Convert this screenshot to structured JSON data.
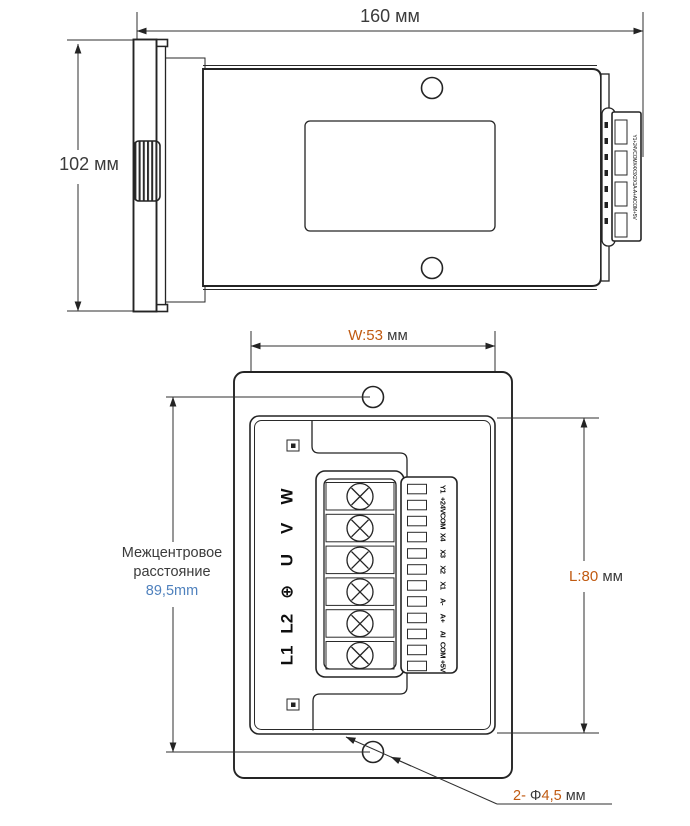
{
  "colors": {
    "line": "#242424",
    "dimension_text": "#3b3b3b",
    "accent_orange": "#c05a11",
    "accent_blue": "#4f81bd"
  },
  "top_view": {
    "width_label": "160 мм",
    "height_label": "102 мм",
    "connector_side_text": "Y1+24VCOMX4X3X2X1A-A+AICOM+5V"
  },
  "front_view": {
    "width_value": "W:53",
    "width_unit": " мм",
    "length_value": "L:80",
    "length_unit": " мм",
    "center_distance": {
      "line1": "Межцентровое",
      "line2": "расстояние",
      "value": "89,5mm"
    },
    "hole_note": {
      "count": "2- ",
      "phi": "Φ",
      "value": "4,5",
      "unit": " мм"
    },
    "phase_terminals": [
      "L1",
      "L2",
      "⊕",
      "U",
      "V",
      "W"
    ],
    "phase_terminals_order": "bottom-to-top",
    "io_terminals": [
      "Y1",
      "+24V",
      "COM",
      "X4",
      "X3",
      "X2",
      "X1",
      "A-",
      "A+",
      "AI",
      "COM",
      "+5V"
    ]
  }
}
